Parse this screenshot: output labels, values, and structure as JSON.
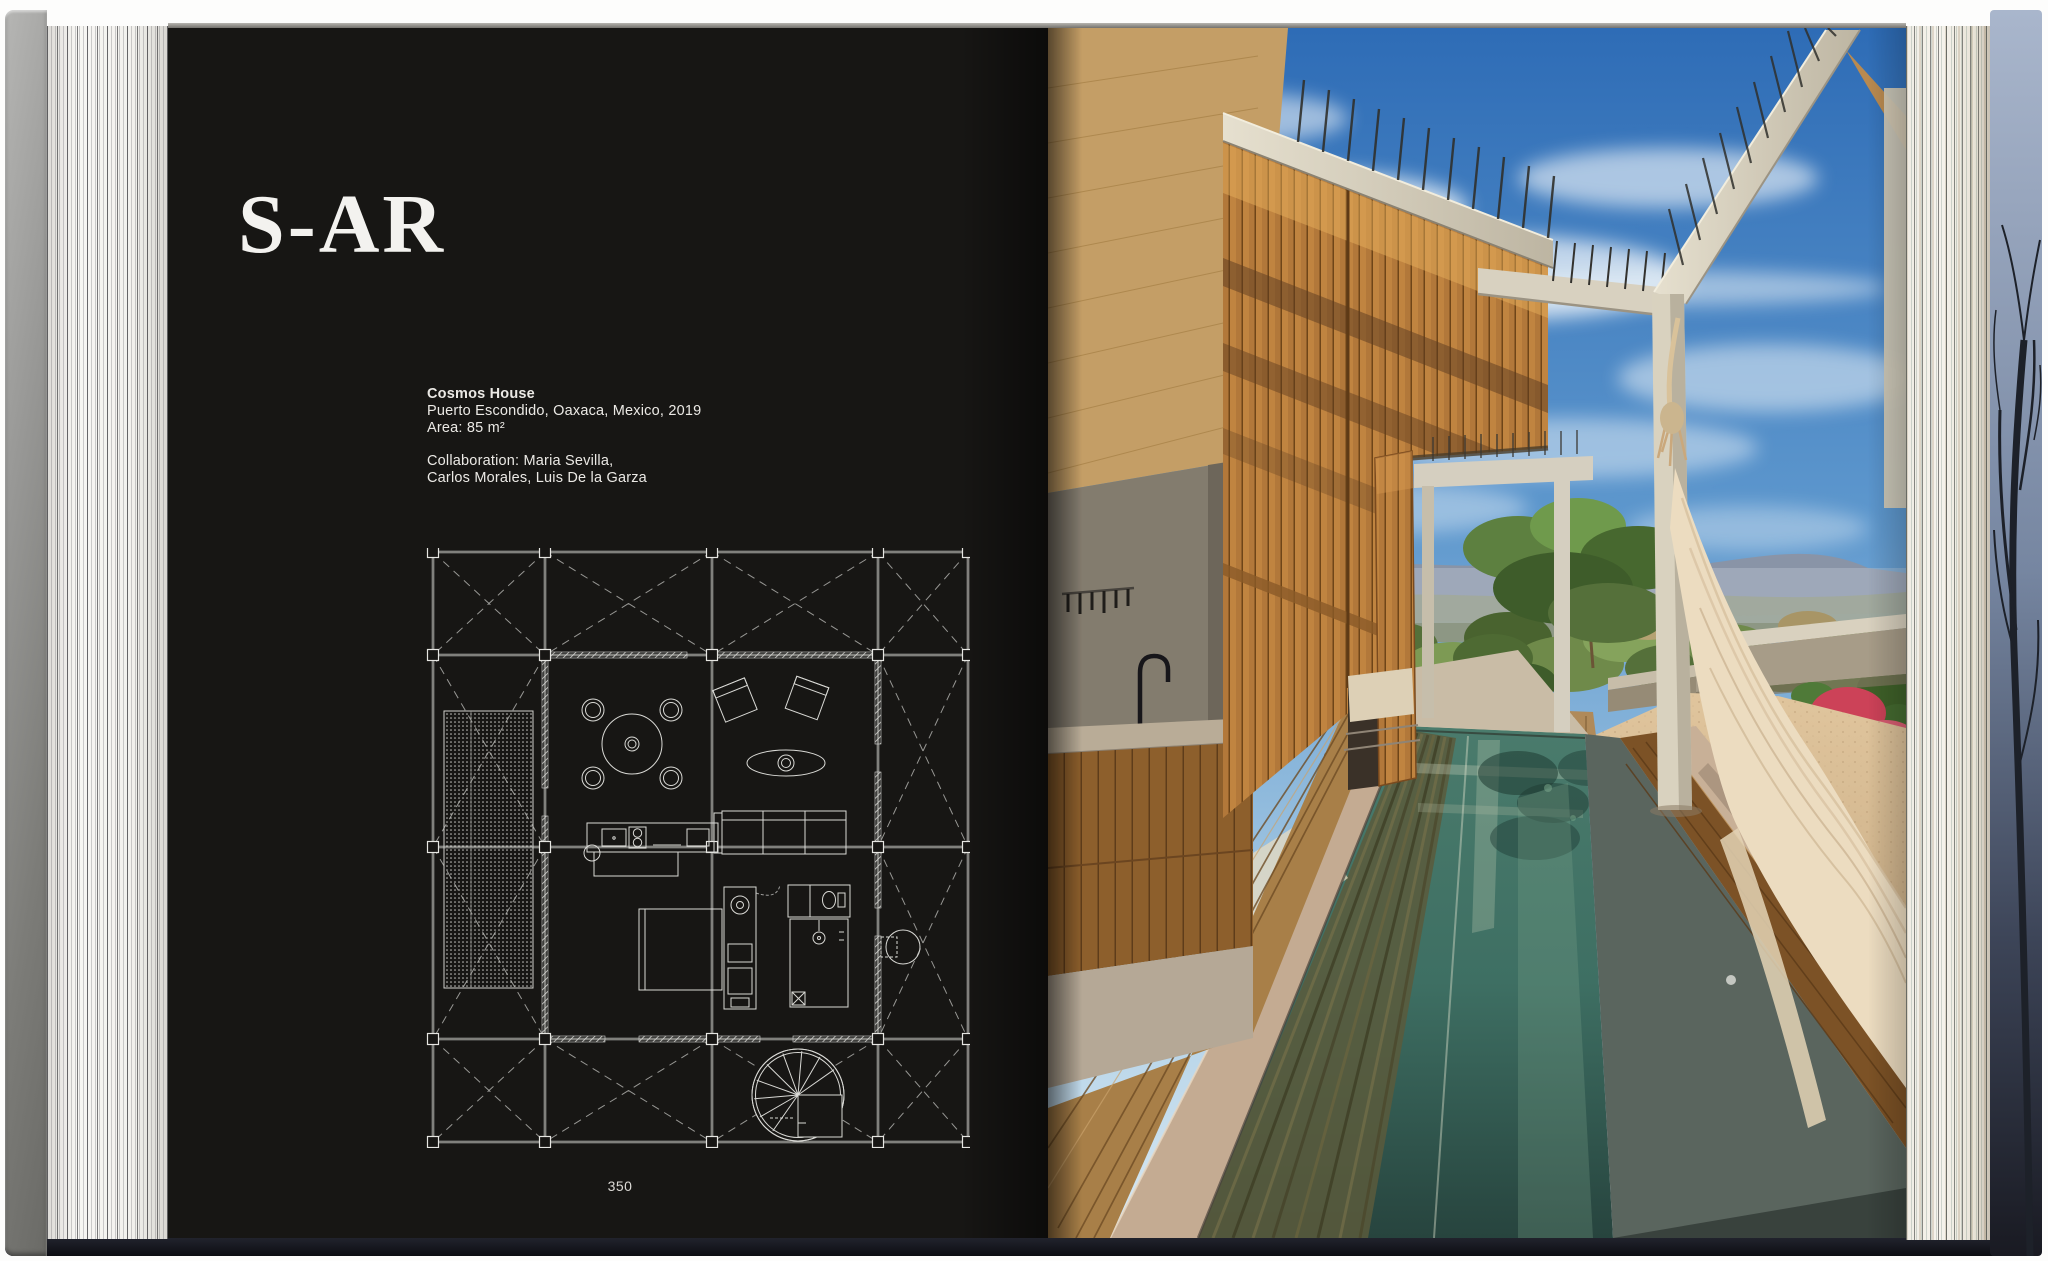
{
  "left_page": {
    "architect": "S-AR",
    "project": {
      "name": "Cosmos House",
      "location": "Puerto Escondido, Oaxaca, Mexico, 2019",
      "area": "Area: 85 m²",
      "collaboration_1": "Collaboration: Maria Sevilla,",
      "collaboration_2": "Carlos Morales, Luis De la Garza"
    },
    "page_number": "350"
  },
  "colors": {
    "page-black": "#171614",
    "paper": "#f4f2ee",
    "text-light": "#ebe9e5",
    "plan-line": "#d6d6d2",
    "sky-top": "#2e6cb6",
    "pool-teal": "#3e6f63",
    "wood-orange": "#c08440",
    "sand": "#d8bd96",
    "flower-red": "#cc4258",
    "concrete-light": "#e3ddcc",
    "cover-navy": "#171922"
  }
}
